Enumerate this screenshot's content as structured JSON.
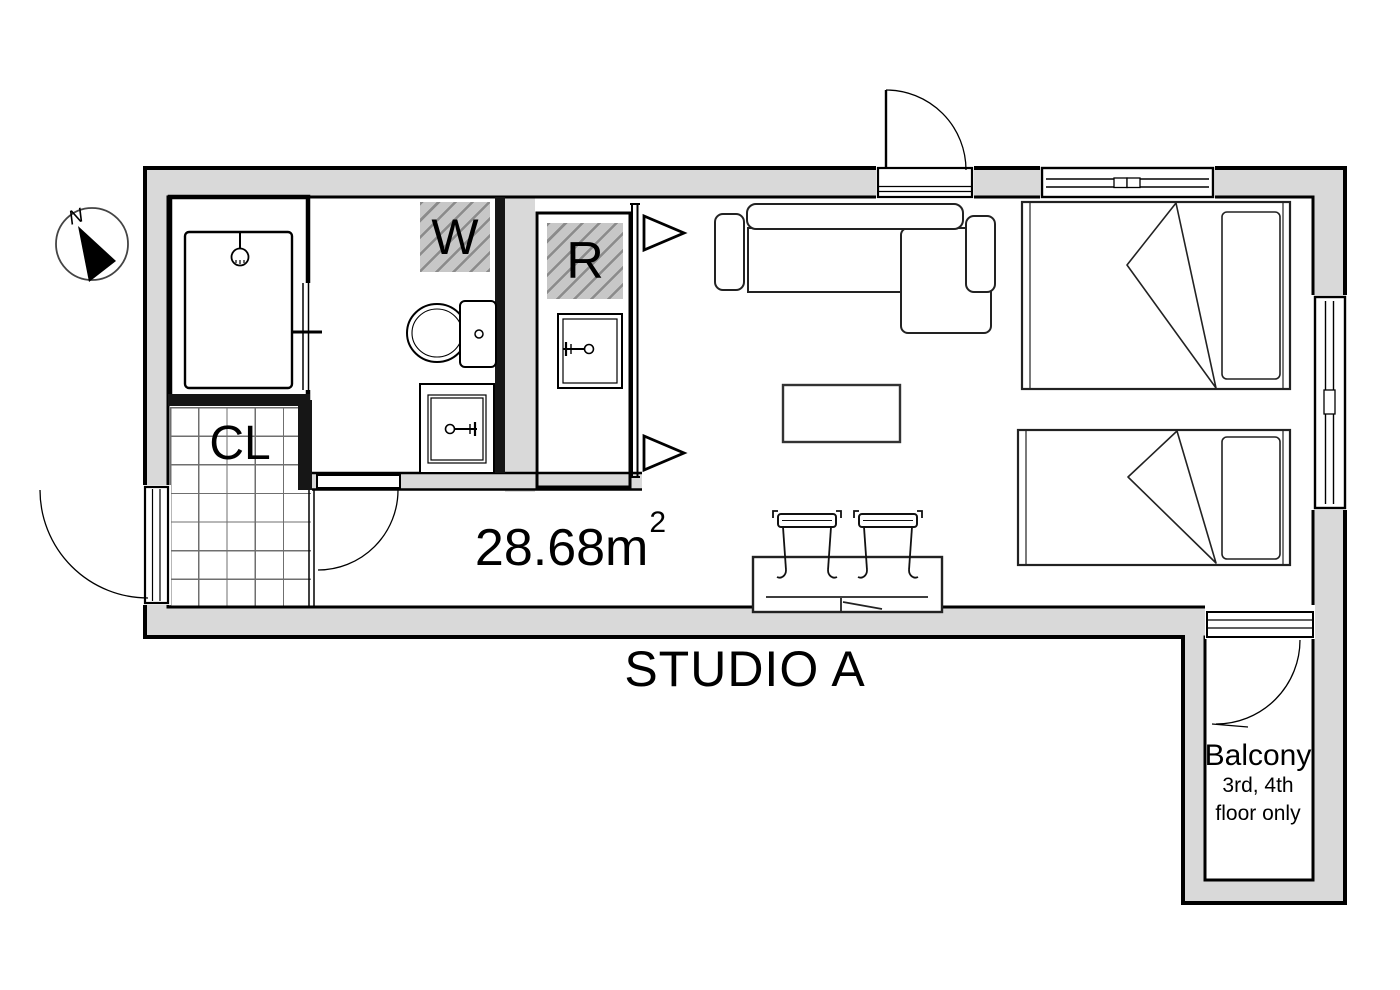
{
  "title": "STUDIO A",
  "area": {
    "value": "28.68m",
    "sup": "2"
  },
  "labels": {
    "closet": "CL",
    "washer": "W",
    "refrigerator": "R"
  },
  "balcony": {
    "name": "Balcony",
    "note_line1": "3rd, 4th",
    "note_line2": "floor only"
  },
  "compass": {
    "north": "N"
  },
  "colors": {
    "wall_fill": "#d9d9d9",
    "hatch_bg": "#c7c7c7",
    "hatch_line": "#8b8b8b",
    "outline": "#000000"
  }
}
